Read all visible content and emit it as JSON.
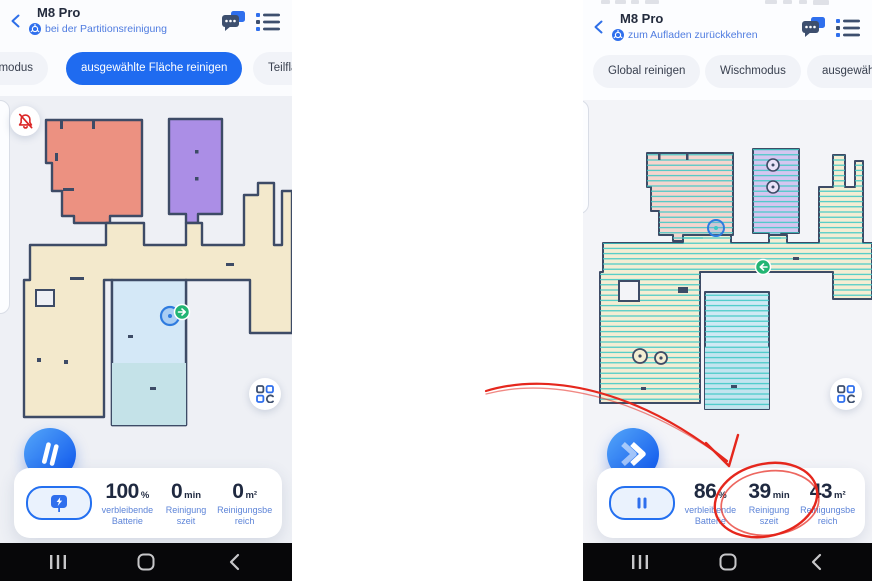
{
  "colors": {
    "accent": "#1f6bf0",
    "annotation_red": "#e5271d",
    "status_blue": "#4f7ce0",
    "number_navy": "#1f2940",
    "label_blue": "#5d84d8"
  },
  "left_screen": {
    "header": {
      "title": "M8 Pro",
      "status": "bei der Partitionsreinigung"
    },
    "tabs": {
      "0": {
        "label": "hmodus"
      },
      "1": {
        "label": "ausgewählte Fläche reinigen"
      },
      "2": {
        "label": "Teilfläc"
      }
    },
    "stats": {
      "0": {
        "value": "100",
        "unit": "%",
        "label_line1": "verbleibende",
        "label_line2": "Batterie"
      },
      "1": {
        "value": "0",
        "unit": "min",
        "label_line1": "Reinigung",
        "label_line2": "szeit"
      },
      "2": {
        "value": "0",
        "unit": "m²",
        "label_line1": "Reinigungsbe",
        "label_line2": "reich"
      }
    },
    "primary_button": "pause",
    "dock_button": "charge"
  },
  "right_screen": {
    "header": {
      "title": "M8 Pro",
      "status": "zum Aufladen zurückkehren"
    },
    "tabs": {
      "0": {
        "label": "Global reinigen"
      },
      "1": {
        "label": "Wischmodus"
      },
      "2": {
        "label": "ausgewähl"
      }
    },
    "stats": {
      "0": {
        "value": "86",
        "unit": "%",
        "label_line1": "verbleibende",
        "label_line2": "Batterie"
      },
      "1": {
        "value": "39",
        "unit": "min",
        "label_line1": "Reinigung",
        "label_line2": "szeit"
      },
      "2": {
        "value": "43",
        "unit": "m²",
        "label_line1": "Reinigungsbe",
        "label_line2": "reich"
      }
    },
    "primary_button": "resume",
    "dock_button": "pause"
  },
  "annotation": {
    "type": "hand-drawn red arrow and circle",
    "target": "Reinigungszeit 39 min"
  }
}
